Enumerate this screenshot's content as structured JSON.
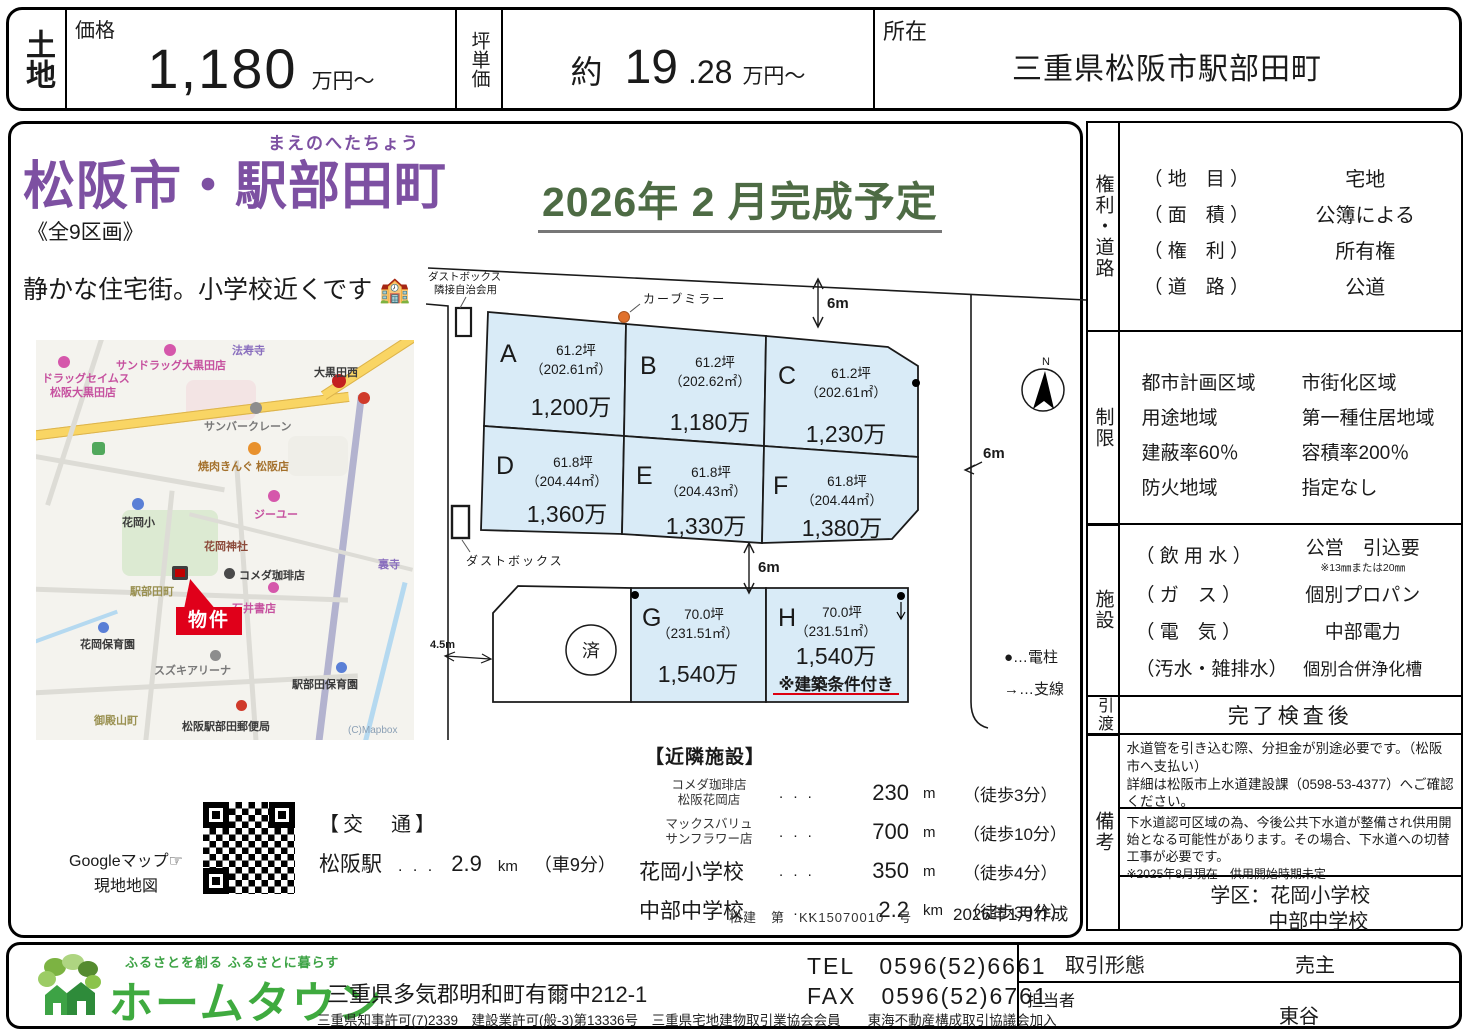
{
  "header": {
    "land_type": "土地",
    "price_label": "価格",
    "price_value": "1,180",
    "price_unit": "万円～",
    "tsubo_label": "坪単価",
    "approx": "約",
    "tsubo_int": "19",
    "tsubo_dec": ".28",
    "tsubo_unit": "万円～",
    "location_label": "所在",
    "location_value": "三重県松阪市駅部田町"
  },
  "main": {
    "furigana": "まえのへたちょう",
    "title": "松阪市・駅部田町",
    "lots": "《全9区画》",
    "catch": "静かな住宅街。小学校近くです",
    "school_emoji": "🏫",
    "completion": "2026年 2 月完成予定"
  },
  "map": {
    "labels": [
      "ドラッグセイムス",
      "松阪大黒田店",
      "サンドラッグ大黒田店",
      "法寿寺",
      "大黒田西",
      "サンバークレーン",
      "焼肉きんぐ 松阪店",
      "ジーユー",
      "花岡小",
      "花岡神社",
      "コメダ珈琲店",
      "裏寺",
      "駅部田町",
      "石井書店",
      "花岡保育園",
      "スズキアリーナ",
      "駅部田保育園",
      "御殿山町",
      "松阪駅部田郵便局",
      "(C)Mapbox"
    ],
    "property_label": "物件",
    "qr_caption1": "Googleマップ☞",
    "qr_caption2": "現地地図"
  },
  "access": {
    "heading": "【交　通】",
    "name": "松阪駅",
    "dots": ". . .",
    "value": "2.9",
    "unit": "km",
    "time": "（車9分）"
  },
  "plots": {
    "list": [
      {
        "id": "A",
        "tsubo": "61.2坪",
        "sqm": "（202.61㎡）",
        "price": "1,200万"
      },
      {
        "id": "B",
        "tsubo": "61.2坪",
        "sqm": "（202.62㎡）",
        "price": "1,180万"
      },
      {
        "id": "C",
        "tsubo": "61.2坪",
        "sqm": "（202.61㎡）",
        "price": "1,230万"
      },
      {
        "id": "D",
        "tsubo": "61.8坪",
        "sqm": "（204.44㎡）",
        "price": "1,360万"
      },
      {
        "id": "E",
        "tsubo": "61.8坪",
        "sqm": "（204.43㎡）",
        "price": "1,330万"
      },
      {
        "id": "F",
        "tsubo": "61.8坪",
        "sqm": "（204.44㎡）",
        "price": "1,380万"
      },
      {
        "id": "G",
        "tsubo": "70.0坪",
        "sqm": "（231.51㎡）",
        "price": "1,540万"
      },
      {
        "id": "H",
        "tsubo": "70.0坪",
        "sqm": "（231.51㎡）",
        "price": "1,540万",
        "note": "※建築条件付き"
      }
    ],
    "sold": "済",
    "labels": {
      "mirror": "カーブミラー",
      "dust1a": "ダストボックス",
      "dust1b": "隣接自治会用",
      "dust2": "ダストボックス",
      "m6": "6m",
      "m6b": "6m",
      "m6c": "6m",
      "m45": "4.5m",
      "north": "N",
      "pole": "●…電柱",
      "wire": "→…支線"
    }
  },
  "nearby": {
    "heading": "【近隣施設】",
    "dots": ". . .",
    "items": [
      {
        "name1": "コメダ珈琲店",
        "name2": "松阪花岡店",
        "value": "230",
        "unit": "m",
        "time": "（徒歩3分）"
      },
      {
        "name1": "マックスバリュ",
        "name2": "サンフラワー店",
        "value": "700",
        "unit": "m",
        "time": "（徒歩10分）"
      },
      {
        "name1": "花岡小学校",
        "value": "350",
        "unit": "m",
        "time": "（徒歩4分）"
      },
      {
        "name1": "中部中学校",
        "value": "2.2",
        "unit": "km",
        "time": "（徒歩30分）"
      }
    ],
    "license": "松建　第　KK15070010　号",
    "created": "2026年1月作成"
  },
  "sidebar": {
    "rights": {
      "label": "権利・道路",
      "rows": [
        {
          "k": "（ 地　目 ）",
          "v": "宅地"
        },
        {
          "k": "（ 面　積 ）",
          "v": "公簿による"
        },
        {
          "k": "（ 権　利 ）",
          "v": "所有権"
        },
        {
          "k": "（ 道　路 ）",
          "v": "公道"
        }
      ]
    },
    "limits": {
      "label": "制限",
      "rows": [
        {
          "k": "都市計画区域",
          "v": "市街化区域"
        },
        {
          "k": "用途地域",
          "v": "第一種住居地域"
        },
        {
          "k": "建蔽率60％",
          "v": "容積率200％"
        },
        {
          "k": "防火地域",
          "v": "指定なし"
        }
      ]
    },
    "utils": {
      "label": "施設",
      "rows": [
        {
          "k": "（ 飲 用 水 ）",
          "v": "公営　引込要",
          "note": "※13㎜または20㎜"
        },
        {
          "k": "（ ガ　ス ）",
          "v": "個別プロパン"
        },
        {
          "k": "（ 電　気 ）",
          "v": "中部電力"
        },
        {
          "k": "（汚水・雑排水）",
          "v": "個別合併浄化槽"
        }
      ]
    },
    "handover": {
      "label": "引渡",
      "value": "完了検査後"
    },
    "remarks": {
      "label": "備考",
      "note1a": "水道管を引き込む際、分担金が別途必要です。（松阪市へ支払い）",
      "note1b": "詳細は松阪市上水道建設課（0598-53-4377）へご確認ください。",
      "note2": "下水道認可区域の為、今後公共下水道が整備され供用開始となる可能性があります。その場合、下水道への切替工事が必要です。",
      "note2b": "※2025年8月現在　供用開始時期未定",
      "school1": "学区：花岡小学校",
      "school2": "中部中学校"
    }
  },
  "footer": {
    "tagline": "ふるさとを創る ふるさとに暮らす",
    "company": "ホームタウン",
    "address": "三重県多気郡明和町有爾中212-1",
    "licenses": "三重県知事許可(7)2339　建設業許可(般-3)第13336号　三重県宅地建物取引業協会会員　　東海不動産構成取引協議会加入",
    "tel": "TEL　0596(52)6661",
    "fax": "FAX　0596(52)6761",
    "deal_label": "取引形態",
    "deal_value": "売主",
    "agent_label": "担当者",
    "agent_value": "東谷"
  },
  "colors": {
    "accent_red": "#e0001a",
    "title_purple": "#7d50a2",
    "completion_green": "#4d6b44",
    "plot_fill_blue": "#d9ebf7",
    "logo_green": "#3faa3f",
    "map_road_yellow": "#f9d564"
  }
}
